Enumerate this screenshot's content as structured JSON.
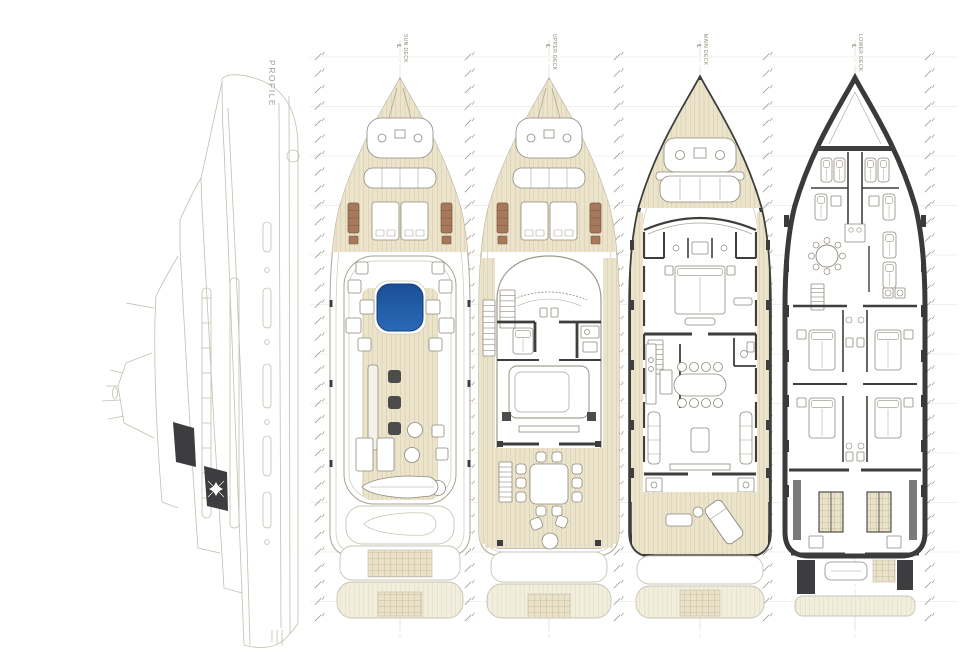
{
  "sheet": {
    "type": "yacht-general-arrangement-drawing",
    "background": "#ffffff"
  },
  "profile": {
    "label": "PROFILE",
    "features": [
      "hull",
      "superstructure",
      "mast-antennas",
      "hull-windows",
      "dark-glass-panels",
      "star-emblem",
      "bow-thruster",
      "swim-platform"
    ]
  },
  "decks": [
    {
      "id": "sun-deck",
      "label": "SUN DECK",
      "cx": 400,
      "features": [
        "foredeck-sunpads",
        "anchor-windlass",
        "bow-seating",
        "sun-loungers",
        "jacuzzi",
        "bar",
        "bar-stools",
        "cocktail-tables",
        "sunbeds",
        "tender",
        "aft-deck-ghost"
      ]
    },
    {
      "id": "upper-deck",
      "label": "UPPER DECK",
      "cx": 549,
      "features": [
        "foredeck-sunpads",
        "anchor-windlass",
        "bow-seating",
        "wheelhouse",
        "helm-console",
        "stairs",
        "sky-lounge-sofa",
        "al-fresco-dining",
        "dining-chairs",
        "round-table",
        "aft-deck"
      ]
    },
    {
      "id": "main-deck",
      "label": "MAIN DECK",
      "cx": 700,
      "features": [
        "bulwark",
        "teak-foredeck",
        "anchor-windlass",
        "bow-sunpad",
        "owner-suite",
        "owner-bed",
        "bathrooms",
        "galley",
        "dining-table",
        "saloon-sofas",
        "coffee-table",
        "aft-deck",
        "chaise-longue",
        "stern-platform"
      ]
    },
    {
      "id": "lower-deck",
      "label": "LOWER DECK",
      "cx": 855,
      "features": [
        "forepeak",
        "crew-bunks",
        "crew-mess",
        "crew-galley",
        "laundry",
        "guest-cabins",
        "guest-beds",
        "bathrooms",
        "engine-room",
        "engines",
        "tender-garage",
        "swim-platform"
      ]
    }
  ],
  "stations": {
    "tick_columns_x": [
      318,
      468,
      617,
      766,
      928
    ],
    "y_start": 57,
    "y_end": 633,
    "step": 16.5,
    "major_every": 3
  },
  "colors": {
    "teak": "#ebe4cb",
    "teak_line": "#cfc6a6",
    "teak_ghost": "#f2eedd",
    "teak_ghost_line": "#ded7bd",
    "grid_bg": "#e9e2c9",
    "grid_line": "#bab194",
    "hull_light": "#b2ad9c",
    "inner_line": "#ccc7b6",
    "wall": "#3e3e3c",
    "dark_fill": "#3d3d3f",
    "furn": "#8f897c",
    "furn_light": "#a9a396",
    "jacuzzi_top": "#1a4f96",
    "jacuzzi_bottom": "#2a6ab6",
    "jacuzzi_stroke": "#153f78",
    "lounger": "#a5795b",
    "lounger_stroke": "#7d5740",
    "stool": "#4c4c4c",
    "ghost": "#c9c4b4",
    "tick": "#8b8b87",
    "gridline": "#ecebe4",
    "centerline": "#d8d5c8",
    "profile_line": "#c3bfb1",
    "label": "#8f8a78"
  }
}
